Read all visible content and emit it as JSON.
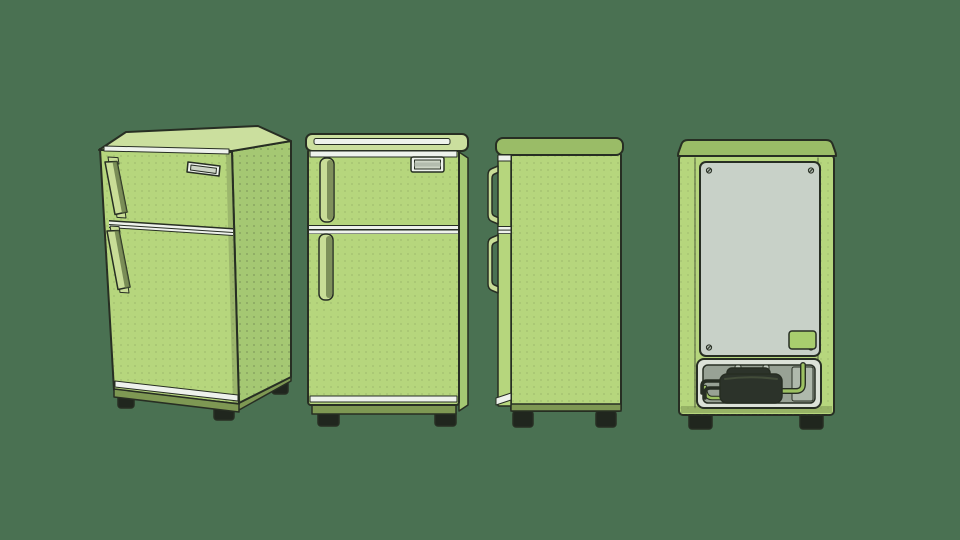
{
  "illustration": {
    "subject": "compact two-door refrigerator shown in four views",
    "views": [
      {
        "name": "refrigerator-three-quarter-view"
      },
      {
        "name": "refrigerator-front-view"
      },
      {
        "name": "refrigerator-side-view"
      },
      {
        "name": "refrigerator-back-view"
      }
    ]
  },
  "colors": {
    "background": "#4A7152",
    "outline": "#272E23",
    "body_green": "#B6D67D",
    "body_green_light": "#CBDF9E",
    "side_green": "#A5C873",
    "cap_green": "#9ABC67",
    "base_olive": "#7E9853",
    "trim_white": "#EEF2EC",
    "handle_light": "#C9DD97",
    "handle_shadow": "#5F7142",
    "feet_dark": "#20261E",
    "panel_gray": "#C8D1C8",
    "panel_screw": "#A9B3A8",
    "compartment_frame": "#DCE2D8",
    "compartment_gray": "#98A295",
    "compartment_light": "#AFB9AC",
    "compressor_dark": "#2C332A",
    "compressor_ridge": "#454F3B",
    "pipe_green": "#9CC162",
    "pipe_gray": "#C4CDC1",
    "label_green": "#A8CE6E",
    "plate_inner": "#CDD5C6",
    "plate_bar": "#B3BCAE",
    "dot_texture": "#55663F"
  }
}
